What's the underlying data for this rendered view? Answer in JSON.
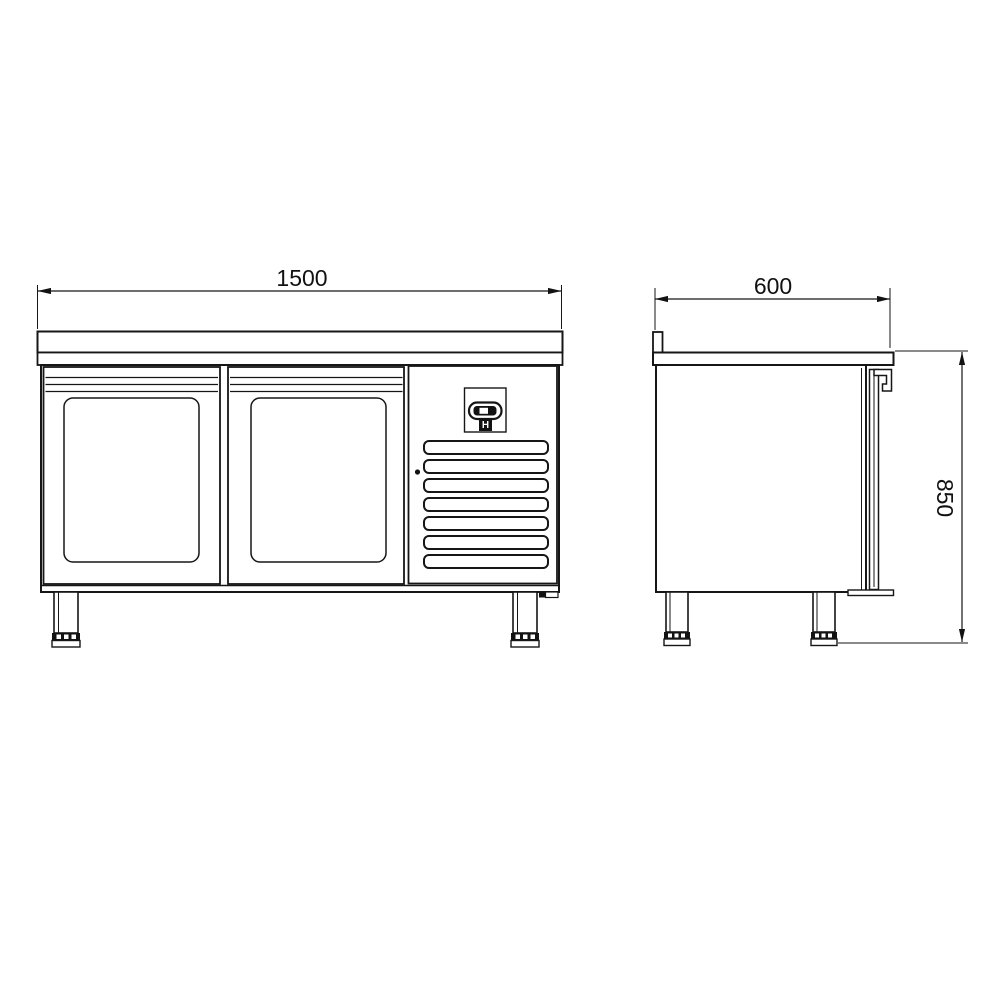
{
  "colors": {
    "background": "#ffffff",
    "line": "#161616",
    "text": "#111111"
  },
  "front_view": {
    "width_dim": "1500",
    "controller_label": "H",
    "door_count": 2,
    "vent_slat_count": 7
  },
  "side_view": {
    "depth_dim": "600",
    "height_dim": "850"
  }
}
